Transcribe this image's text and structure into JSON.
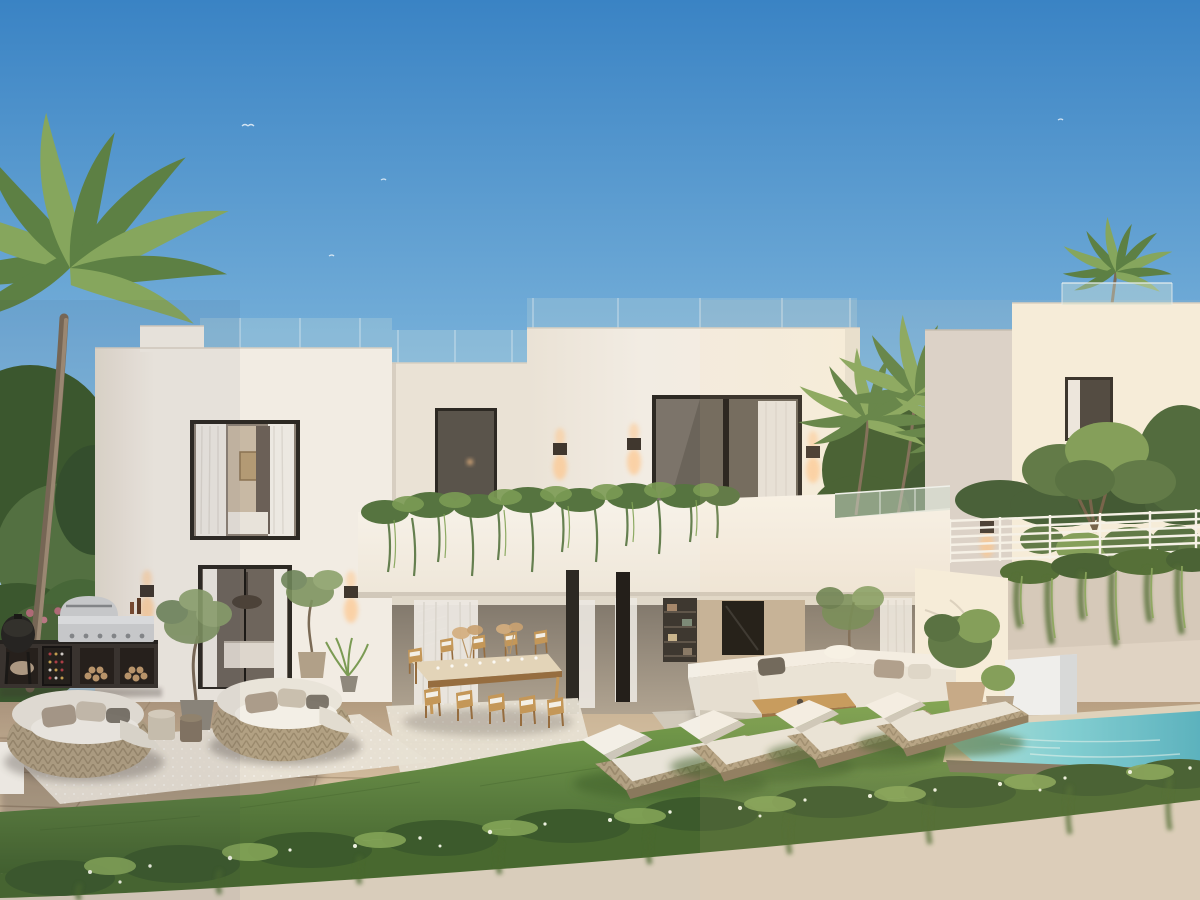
{
  "scene": {
    "aria_label": "Architectural rendering of a modern two-storey white villa at dusk with palm trees, balcony planters, outdoor kitchen with barbecue, round rattan daybeds, long wooden dining table, corner sofa, four sun loungers on a lawn, a small turquoise pool and a green hedge in the foreground",
    "time_of_day": "late afternoon",
    "style": "contemporary cubic villa"
  },
  "colors": {
    "skyTop": "#3a83c4",
    "skyMid": "#7cb4db",
    "skyLow": "#d3ebf6",
    "wallLit": "#f2ece3",
    "wallMid": "#eae2d5",
    "wallShade": "#e2dacd",
    "wallCool": "#d9d2ca",
    "wallWarm": "#f6eedd",
    "parapet": "#d8d0c2",
    "frame": "#2d2923",
    "glass": "#6b645a",
    "glassDim": "#554f47",
    "curtain": "#ece8e1",
    "interiorWarm": "#c3b096",
    "interiorDark": "#564e44",
    "plantDark": "#3c5a2c",
    "plant": "#567440",
    "plantLight": "#7b9b54",
    "vine": "#48682f",
    "vineLight": "#83a457",
    "flower": "#edf1e0",
    "palm": "#5d8044",
    "palmLight": "#86a65d",
    "trunk": "#a18d74",
    "trunkDark": "#7b6a55",
    "paving": "#cdb699",
    "pavingLight": "#e0cbab",
    "pavingShade": "#b29b7f",
    "joint": "#9a8367",
    "grass": "#5d8040",
    "grassLight": "#7aa24d",
    "grassDark": "#41602c",
    "water": "#7bcfd6",
    "waterDeep": "#4fafc0",
    "waterPale": "#aadfd8",
    "coping": "#ddd2bd",
    "stoneEdge": "#80755f",
    "wood": "#c49758",
    "woodDark": "#966d3f",
    "cushion": "#e9e4d9",
    "cushionHi": "#f3efe6",
    "cushionShade": "#cdc7ba",
    "weave": "#b2a183",
    "weaveDark": "#8a795d",
    "pillowDark": "#686156",
    "taupe": "#ab9c8a",
    "steel": "#d0d1d1",
    "steelDark": "#878a8b",
    "kitchenDark": "#3a342d",
    "glow": "#ffc487",
    "sconceBody": "#40372e",
    "rug": "#e7e0d3",
    "rugCool": "#d2cbbe",
    "pot": "#b1a088",
    "potClay": "#c3a685",
    "potGray": "#8f887c",
    "white": "#f7f3ea",
    "railGlass": "#cfe0d8",
    "boundaryWall": "#ded3c6",
    "boundaryWallShade": "#cbbfb2",
    "shadow": "#3a332a",
    "tv": "#15130f",
    "bookshelf": "#3e3830"
  }
}
